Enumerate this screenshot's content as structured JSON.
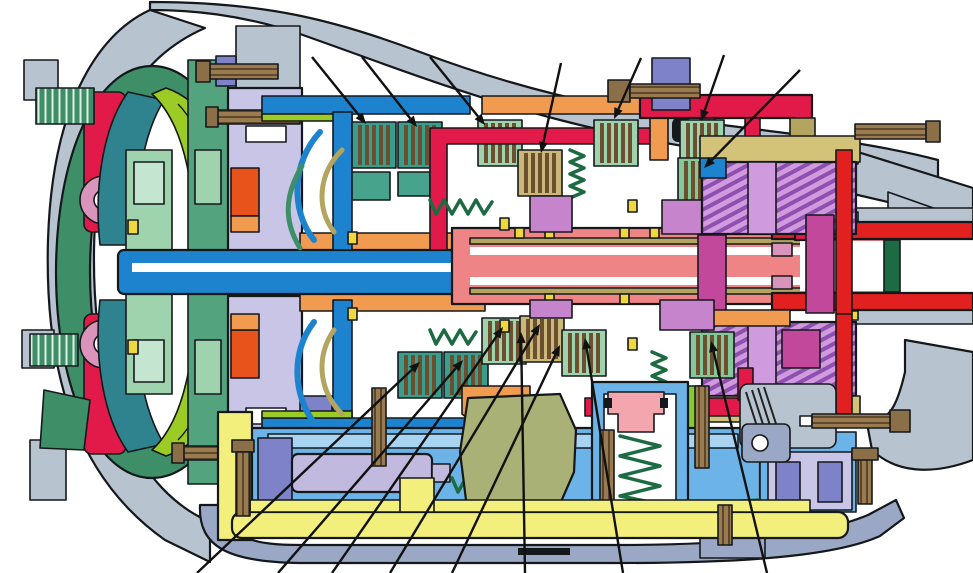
{
  "figure": {
    "kind": "technical-cutaway-illustration",
    "subject": "automatic-transmission-cross-section",
    "background": "#ffffff",
    "canvas": {
      "width": 973,
      "height": 573
    },
    "visible_text": ""
  },
  "palette": {
    "bg": "#ffffff",
    "ink": "#15181b",
    "line": "#111111",
    "case": "#b7c4d0",
    "slate": "#9aa8c6",
    "shellGreen": "#3e8e68",
    "crimson": "#e21a49",
    "teal": "#2e838f",
    "lime": "#9bcc26",
    "paleGreen": "#9fd3ae",
    "seafoam": "#c4e6d0",
    "midGreen": "#53a37e",
    "pinkRing": "#d894ba",
    "blue": "#1d83cf",
    "ltBlue": "#9fd0ee",
    "salmon": "#ef8486",
    "orange": "#f09b50",
    "redOrange": "#e8531b",
    "lavender": "#c9c5e6",
    "periwinkle": "#7e82c8",
    "yellow": "#efd83e",
    "khaki": "#b3a55f",
    "tanRing": "#d3c379",
    "brown": "#8a6f48",
    "tealGreen": "#47a38c",
    "darkGreen": "#1c6b42",
    "orchid": "#c584cc",
    "magenta": "#c2489c",
    "gearLilac": "#cf9ade",
    "gearStripe": "#8f4fae",
    "brightRed": "#e32020",
    "limeBar": "#86cc30",
    "vbBlue": "#6cb4e8",
    "vbLight": "#a8d4f2",
    "panYellow": "#f3ef7d",
    "olive": "#a9b176",
    "accPink": "#f3a6ad",
    "valveLav": "#c1bade"
  },
  "components": [
    {
      "name": "bell-housing",
      "color": "case"
    },
    {
      "name": "torque-converter-shell",
      "color": "shellGreen"
    },
    {
      "name": "lockup-damper",
      "color": "crimson"
    },
    {
      "name": "turbine",
      "color": "teal"
    },
    {
      "name": "impeller",
      "color": "lime"
    },
    {
      "name": "stator-hub",
      "color": "paleGreen"
    },
    {
      "name": "oil-pump-housing",
      "color": "lavender"
    },
    {
      "name": "input-shaft",
      "color": "blue"
    },
    {
      "name": "main-shaft",
      "color": "salmon"
    },
    {
      "name": "clutch-friction-plates",
      "color": "brown"
    },
    {
      "name": "clutch-drum-front",
      "color": "blue"
    },
    {
      "name": "clutch-drum-mid",
      "color": "orange"
    },
    {
      "name": "clutch-drum-rear",
      "color": "crimson"
    },
    {
      "name": "planetary-gearset",
      "color": "gearLilac"
    },
    {
      "name": "output-shaft-sleeve",
      "color": "brightRed"
    },
    {
      "name": "valve-body",
      "color": "vbBlue"
    },
    {
      "name": "manual-valve",
      "color": "valveLav"
    },
    {
      "name": "detent-lever",
      "color": "olive"
    },
    {
      "name": "accumulator-piston",
      "color": "accPink"
    },
    {
      "name": "oil-pan",
      "color": "panYellow"
    },
    {
      "name": "extension-housing",
      "color": "case"
    }
  ],
  "callouts": {
    "arrow_length": 11,
    "arrow_halfwidth": 4.5,
    "top": [
      {
        "name": "top-callout-1",
        "from": [
          312,
          57
        ],
        "to": [
          366,
          124
        ]
      },
      {
        "name": "top-callout-2",
        "from": [
          362,
          57
        ],
        "to": [
          417,
          127
        ]
      },
      {
        "name": "top-callout-3",
        "from": [
          430,
          57
        ],
        "to": [
          485,
          125
        ]
      },
      {
        "name": "top-callout-4",
        "from": [
          561,
          63
        ],
        "to": [
          541,
          153
        ]
      },
      {
        "name": "top-callout-5",
        "from": [
          641,
          58
        ],
        "to": [
          614,
          119
        ]
      },
      {
        "name": "top-callout-6",
        "from": [
          724,
          55
        ],
        "to": [
          701,
          121
        ]
      },
      {
        "name": "top-callout-7",
        "from": [
          800,
          70
        ],
        "to": [
          704,
          168
        ]
      }
    ],
    "bottom": [
      {
        "name": "bottom-callout-1",
        "from": [
          197,
          573
        ],
        "to": [
          420,
          362
        ]
      },
      {
        "name": "bottom-callout-2",
        "from": [
          278,
          573
        ],
        "to": [
          463,
          360
        ]
      },
      {
        "name": "bottom-callout-3",
        "from": [
          332,
          573
        ],
        "to": [
          503,
          327
        ]
      },
      {
        "name": "bottom-callout-4",
        "from": [
          390,
          573
        ],
        "to": [
          540,
          324
        ]
      },
      {
        "name": "bottom-callout-5",
        "from": [
          452,
          573
        ],
        "to": [
          560,
          345
        ]
      },
      {
        "name": "bottom-callout-6",
        "from": [
          525,
          573
        ],
        "to": [
          521,
          332
        ]
      },
      {
        "name": "bottom-callout-7",
        "from": [
          623,
          573
        ],
        "to": [
          585,
          338
        ]
      },
      {
        "name": "bottom-callout-8",
        "from": [
          767,
          573
        ],
        "to": [
          711,
          341
        ]
      }
    ]
  }
}
